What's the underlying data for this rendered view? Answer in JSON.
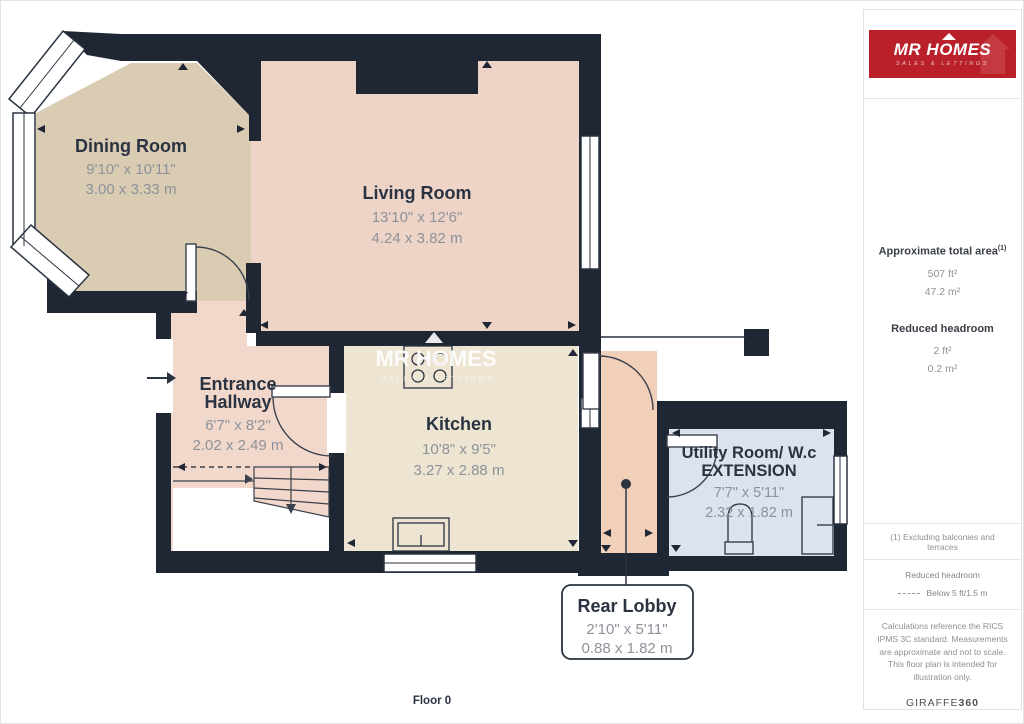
{
  "floorplan": {
    "floor_label": "Floor 0",
    "watermark": {
      "title": "MR HOMES",
      "subtitle": "SALES & LETTINGS"
    },
    "rooms": {
      "dining": {
        "name": "Dining Room",
        "dims_ft": "9'10\" x 10'11\"",
        "dims_m": "3.00 x 3.33 m"
      },
      "living": {
        "name": "Living Room",
        "dims_ft": "13'10\" x 12'6\"",
        "dims_m": "4.24 x 3.82 m"
      },
      "hallway": {
        "name_line1": "Entrance",
        "name_line2": "Hallway",
        "dims_ft": "6'7\" x 8'2\"",
        "dims_m": "2.02 x 2.49 m"
      },
      "kitchen": {
        "name": "Kitchen",
        "dims_ft": "10'8\" x 9'5\"",
        "dims_m": "3.27 x 2.88 m"
      },
      "utility": {
        "name_line1": "Utility Room/ W.c",
        "name_line2": "EXTENSION",
        "dims_ft": "7'7\" x 5'11\"",
        "dims_m": "2.32 x 1.82 m"
      },
      "rear_lobby": {
        "name": "Rear Lobby",
        "dims_ft": "2'10\" x 5'11\"",
        "dims_m": "0.88 x 1.82 m"
      }
    }
  },
  "sidebar": {
    "logo": {
      "title": "MR HOMES",
      "subtitle": "SALES & LETTINGS"
    },
    "area": {
      "heading": "Approximate total area",
      "sup": "(1)",
      "value_ft": "507 ft²",
      "value_m": "47.2 m²"
    },
    "headroom": {
      "heading": "Reduced headroom",
      "value_ft": "2 ft²",
      "value_m": "0.2 m²"
    },
    "note1": "(1) Excluding balconies and terraces",
    "legend": {
      "heading": "Reduced headroom",
      "value": "Below 5 ft/1.5 m"
    },
    "disclaimer": "Calculations reference the RICS IPMS 3C standard. Measurements are approximate and not to scale. This floor plan is intended for illustration only.",
    "brand": {
      "name": "GIRAFFE",
      "suffix": "360"
    }
  },
  "colors": {
    "wall": "#1f2634",
    "dining_fill": "#d9ccb2",
    "living_fill": "#eed4c6",
    "hallway_fill": "#f2d8ca",
    "kitchen_fill": "#ede5d2",
    "rear_lobby_fill": "#f1d0ba",
    "utility_fill": "#dde3ee",
    "logo_red": "#b9202a",
    "title_text": "#2b3342",
    "dims_text": "#8d929b"
  }
}
